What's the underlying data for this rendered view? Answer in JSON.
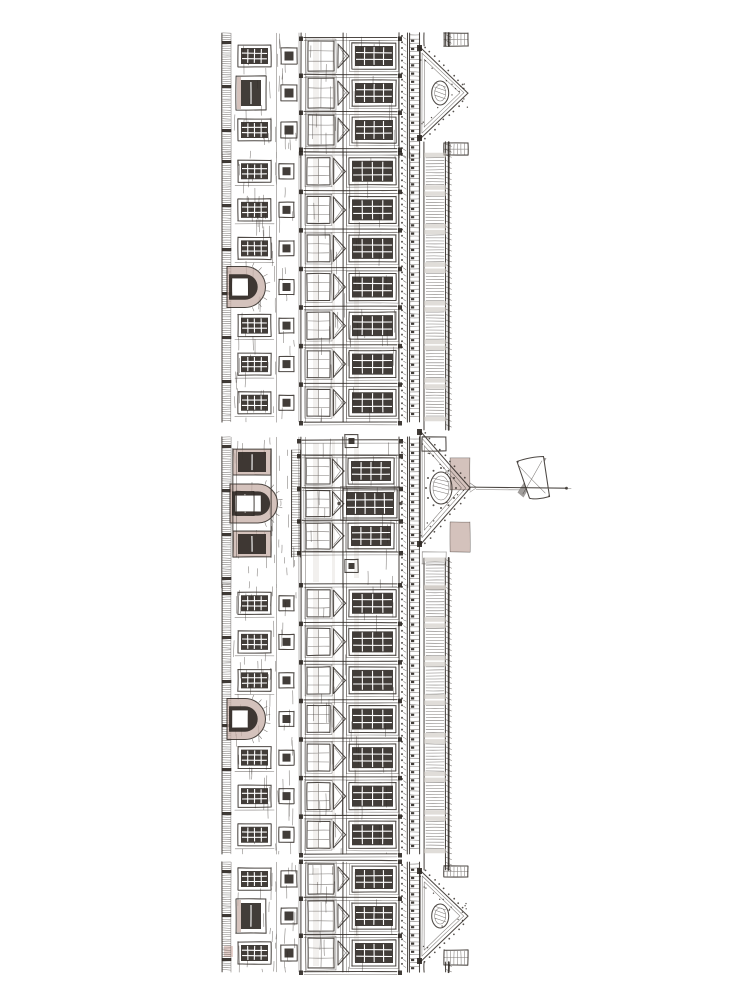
{
  "illustration": {
    "subject": "hand-drawn ink elevation sketch of a palace facade (Buckingham Palace), rotated 90 degrees so the roofline and pediments face right; a Union Jack flag flies from a horizontal flagpole at the central pediment",
    "canvas": {
      "width": 750,
      "height": 1000,
      "background": "#ffffff"
    },
    "palette": {
      "ink": "#2e2823",
      "paper": "#ffffff",
      "wash_tan": "#c5aea5",
      "wash_pink": "#d2a89e",
      "wash_gray": "#ccc6c0",
      "faint_gray": "#dcd7d2"
    },
    "strip": {
      "left": 222,
      "hatch_right": 231,
      "ground_right": 300,
      "main_right": 398,
      "modillions": [
        399,
        407.5
      ],
      "dentils": [
        409.5,
        419.5
      ],
      "balustrade": [
        424,
        445.5
      ],
      "roof_edge": 448.8,
      "apex_x": 468,
      "top": 33,
      "bottom": 972
    },
    "sections": [
      {
        "id": "pavilion-top",
        "kind": "pavilion",
        "y0": 33,
        "y1": 158,
        "apex_y": 93
      },
      {
        "id": "bays-upper",
        "kind": "bays",
        "y0": 152,
        "y1": 422,
        "bays": 7,
        "arch_row": 3
      },
      {
        "id": "centre-pavilion",
        "kind": "centre",
        "y0": 437,
        "y1": 588,
        "apex_y": 488,
        "rows": [
          471,
          503.5,
          536
        ],
        "arch_y": 503.5
      },
      {
        "id": "bays-lower",
        "kind": "bays",
        "y0": 584,
        "y1": 854,
        "bays": 7,
        "arch_row": 3
      },
      {
        "id": "pavilion-bottom",
        "kind": "pavilion",
        "y0": 862,
        "y1": 972,
        "apex_y": 916
      }
    ],
    "rail_segments": [
      [
        33,
        46
      ],
      [
        142,
        430
      ],
      [
        558,
        870
      ],
      [
        962,
        972
      ]
    ],
    "pediment": {
      "base_x": 420,
      "pavilion_half": 46,
      "centre_half": 57,
      "centre_apex_x": 470,
      "tan_panels": [
        [
          450,
          458,
          20,
          32
        ],
        [
          450,
          522,
          20,
          30
        ]
      ]
    },
    "bay": {
      "ground_window": {
        "x": 238,
        "w": 33,
        "h": 22,
        "cols": 4,
        "rows": 3
      },
      "square_window": {
        "x": 279,
        "s": 15
      },
      "french_window": {
        "x": 307,
        "w": 23,
        "h": 27
      },
      "chevron": {
        "x": 333.5,
        "apex_x": 345.5,
        "h": 13
      },
      "main_window": {
        "x": 349,
        "w": 47,
        "h": 27,
        "cols": 4,
        "rows": 3
      },
      "side_arch": {
        "x_flat": 227,
        "r": 20.5,
        "depth": 18
      }
    },
    "pavilion": {
      "row_offset": 37,
      "door": {
        "x": 236,
        "w": 30,
        "h": 34
      },
      "french": {
        "x": 308,
        "w": 26,
        "h": 30
      },
      "grid": {
        "x": 352,
        "w": 44,
        "h": 26
      }
    },
    "centre": {
      "arch": {
        "x_flat": 230,
        "r": 19.5,
        "depth": 28
      },
      "balcony_rails": [
        291.5,
        300.5
      ],
      "balcony_span": [
        450,
        557
      ],
      "recess_y": [
        449,
        531
      ]
    },
    "flagpole": {
      "x0": 470,
      "x1": 566,
      "y": 487.6,
      "tip_x": 571
    },
    "flag": {
      "outline": "M517 461.5 C525 458.5 536 456.5 543.5 456.5 L549.5 496.5 C542 498.8 533 499.6 529.5 498.2 Z",
      "saltire_dark": "M517.5 462.5 L524 460.5 L548.5 492 L543 495.5 Z",
      "saltire_mid": "M540.5 457 L546.5 458.2 L523.5 497.5 L517.5 492.5 Z",
      "fold": "M533.5 457.6 L537.2 457.2 L539.5 498.5 L536 498.9 Z"
    },
    "texture": {
      "hatch_step": 2.2,
      "dentil_step": 4.1,
      "modillion_step": 6.2,
      "baluster_step": 3,
      "wall_stroke_step": 4
    }
  }
}
